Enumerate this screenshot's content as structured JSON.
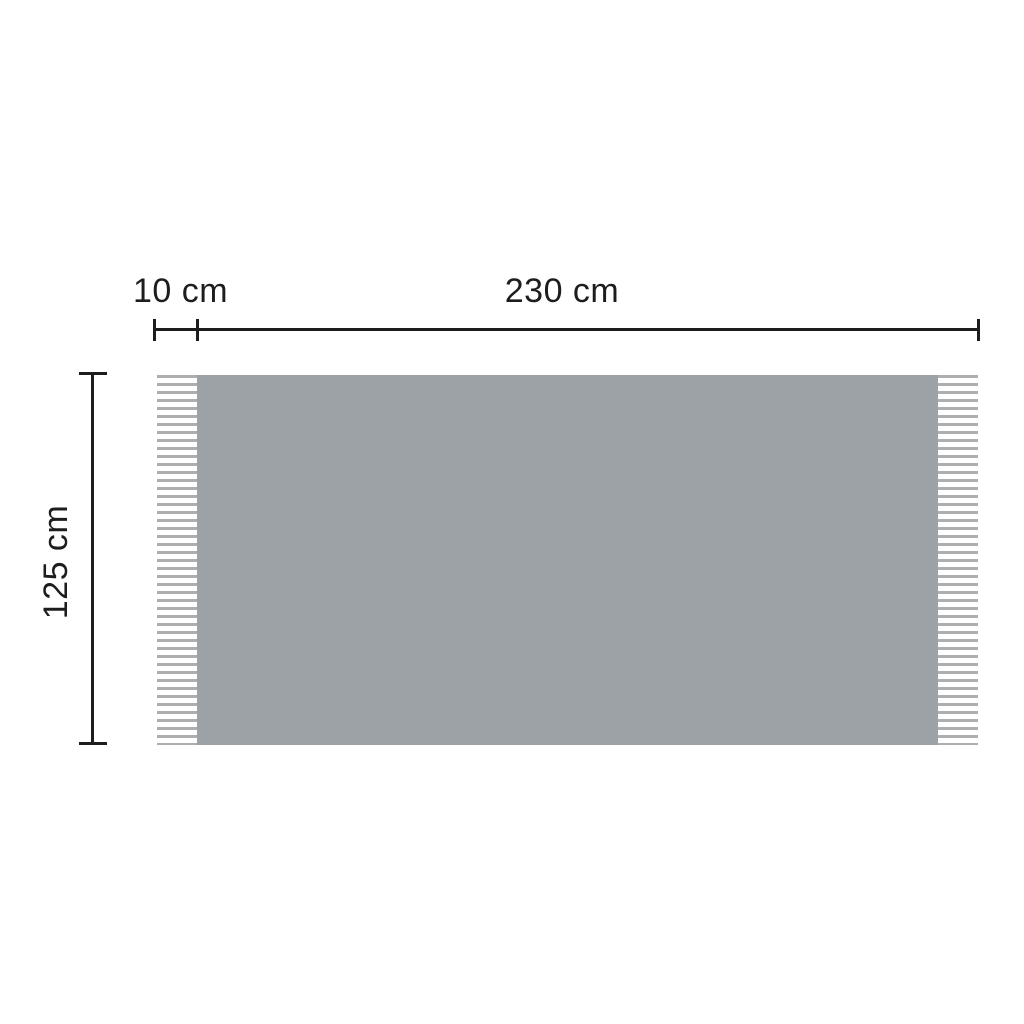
{
  "diagram": {
    "subject": "fringed-blanket-dimensions",
    "labels": {
      "fringe_width": "10 cm",
      "body_width": "230 cm",
      "height": "125 cm"
    },
    "dimensions_cm": {
      "fringe_width": 10,
      "body_width": 230,
      "height": 125
    },
    "colors": {
      "background": "#ffffff",
      "blanket_fill": "#9DA2A6",
      "fringe_strand": "#ACAEB0",
      "dimension_line": "#1D1D1D",
      "text": "#1D1D1D"
    }
  }
}
